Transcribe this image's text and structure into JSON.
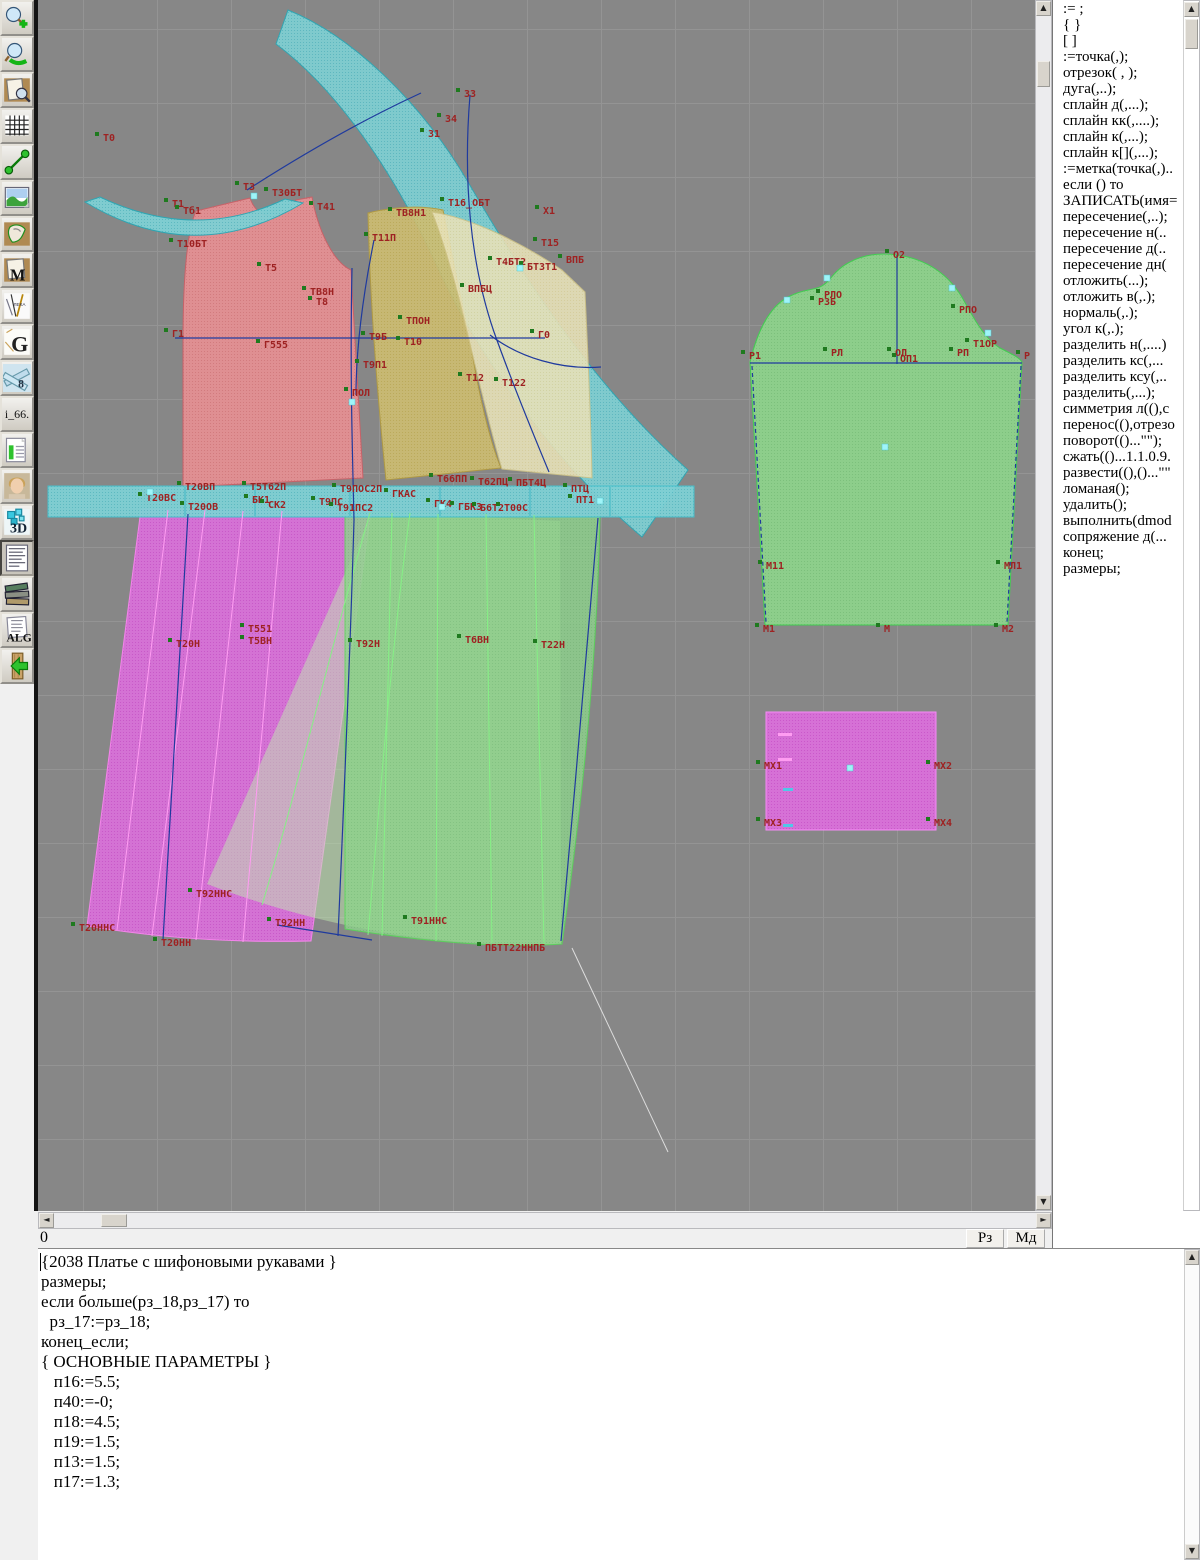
{
  "toolbar": {
    "buttons": [
      {
        "name": "zoom-in"
      },
      {
        "name": "zoom-out"
      },
      {
        "name": "print-preview"
      },
      {
        "name": "grid"
      },
      {
        "name": "measure"
      },
      {
        "name": "image-view"
      },
      {
        "name": "pattern-piece"
      },
      {
        "name": "pattern-m",
        "text": "M"
      },
      {
        "name": "drafting-tools"
      },
      {
        "name": "letter-g",
        "text": "G"
      },
      {
        "name": "rulers",
        "text": "8"
      },
      {
        "name": "i66",
        "text": "i_66."
      },
      {
        "name": "chart-table"
      },
      {
        "name": "portrait"
      },
      {
        "name": "view-3d",
        "text": "3D"
      },
      {
        "name": "text-document"
      },
      {
        "name": "books"
      },
      {
        "name": "alg",
        "text": "ALG"
      },
      {
        "name": "exit"
      }
    ]
  },
  "command_panel": {
    "items": [
      ":= ;",
      "{  }",
      "[  ]",
      ":=точка(,);",
      "отрезок( , );",
      "дуга(,..);",
      "сплайн  д(,...);",
      "сплайн  кк(,....);",
      "сплайн  к(,...);",
      "сплайн  к[](,...);",
      ":=метка(точка(,)..",
      "если () то",
      "ЗАПИСАТЬ(имя=",
      "пересечение(,..);",
      "пересечение  н(..",
      "пересечение  д(..",
      "пересечение  дн(",
      "отложить(...);",
      "отложить  в(,.);",
      "нормаль(,.);",
      "угол  к(,.);",
      "разделить  н(,....)",
      "разделить  кс(,...",
      "разделить  ксу(,..",
      "разделить(,...);",
      "симметрия  л((),с",
      "перенос((),отрезо",
      "поворот(()...\"\");",
      "сжать(()...1.1.0.9.",
      "развести((),()...\"\"",
      "ломаная();",
      "удалить();",
      "выполнить(dmod",
      "сопряжение  д(...",
      "конец;",
      "размеры;"
    ]
  },
  "status": {
    "coords": "0",
    "rz": "Рз",
    "md": "Мд"
  },
  "editor": {
    "lines": [
      "{2038 Платье с шифоновыми рукавами }",
      "",
      "размеры;",
      "",
      "если больше(рз_18,рз_17) то",
      "  рз_17:=рз_18;",
      "конец_если;",
      "",
      "{ ОСНОВНЫЕ ПАРАМЕТРЫ }",
      "   п16:=5.5;",
      "   п40:=-0;",
      "   п18:=4.5;",
      "   п19:=1.5;",
      "   п13:=1.5;",
      "   п17:=1.3;"
    ]
  },
  "canvas": {
    "colors": {
      "background": "#878787",
      "grid": "#949494",
      "cyan": "#7fd0d4",
      "red": "#e79093",
      "yellow": "#cdbd72",
      "pale_yellow": "#e7e1b8",
      "green": "#8ed48c",
      "magenta": "#dd70dd",
      "label": "#9e2222",
      "navy": "#1f3a9e"
    },
    "point_labels": [
      [
        "Т0",
        103,
        141
      ],
      [
        "Т3",
        243,
        190
      ],
      [
        "Т30БТ",
        272,
        196
      ],
      [
        "Т41",
        317,
        210
      ],
      [
        "Т1",
        172,
        207
      ],
      [
        "Тб1",
        183,
        214
      ],
      [
        "Т10БТ",
        177,
        247
      ],
      [
        "Т5",
        265,
        271
      ],
      [
        "Т11П",
        372,
        241
      ],
      [
        "33",
        464,
        97
      ],
      [
        "34",
        445,
        122
      ],
      [
        "31",
        428,
        137
      ],
      [
        "Х1",
        543,
        214
      ],
      [
        "Т15",
        541,
        246
      ],
      [
        "Т16_ОБТ",
        448,
        206
      ],
      [
        "ТВ8Н1",
        396,
        216
      ],
      [
        "ВПБ",
        566,
        263
      ],
      [
        "ВПБЦ",
        468,
        292
      ],
      [
        "Т4БТ2",
        496,
        265
      ],
      [
        "БТ3Т1",
        527,
        270
      ],
      [
        "ТПОН",
        406,
        324
      ],
      [
        "Т9Б",
        369,
        340
      ],
      [
        "Т10",
        404,
        345
      ],
      [
        "Г1",
        172,
        337
      ],
      [
        "Г555",
        264,
        348
      ],
      [
        "Г0",
        538,
        338
      ],
      [
        "Т9П1",
        363,
        368
      ],
      [
        "Т12",
        466,
        381
      ],
      [
        "Т122",
        502,
        386
      ],
      [
        "ПОЛ",
        352,
        396
      ],
      [
        "ТВ8Н",
        310,
        295
      ],
      [
        "Т8",
        316,
        305
      ],
      [
        "Т20ВП",
        185,
        490
      ],
      [
        "Т5Т62П",
        250,
        490
      ],
      [
        "Т9ПОС2П",
        340,
        492
      ],
      [
        "Т66ПП",
        437,
        482
      ],
      [
        "Т62ПЦ",
        478,
        485
      ],
      [
        "ПБТ4Ц",
        516,
        486
      ],
      [
        "ПТЦ",
        571,
        492
      ],
      [
        "ПТ1",
        576,
        503
      ],
      [
        "Т20ВС",
        146,
        501
      ],
      [
        "Т20ОВ",
        188,
        510
      ],
      [
        "БК1",
        252,
        503
      ],
      [
        "СК2",
        268,
        508
      ],
      [
        "Т9ПС",
        319,
        505
      ],
      [
        "Т91ПС2",
        337,
        511
      ],
      [
        "ГКАС",
        392,
        497
      ],
      [
        "ГК4",
        434,
        507
      ],
      [
        "ГБК3",
        458,
        510
      ],
      [
        "Б6Т2",
        480,
        511
      ],
      [
        "Т00С",
        504,
        511
      ],
      [
        "Т20Н",
        176,
        647
      ],
      [
        "Т551",
        248,
        632
      ],
      [
        "Т5ВН",
        248,
        644
      ],
      [
        "Т92Н",
        356,
        647
      ],
      [
        "Т6ВН",
        465,
        643
      ],
      [
        "Т22Н",
        541,
        648
      ],
      [
        "Т92ННС",
        196,
        897
      ],
      [
        "Т20ННС",
        79,
        931
      ],
      [
        "Т20НН",
        161,
        946
      ],
      [
        "Т92НН",
        275,
        926
      ],
      [
        "Т91ННС",
        411,
        924
      ],
      [
        "ПБТТ22ННПБ",
        485,
        951
      ],
      [
        "О2",
        893,
        258
      ],
      [
        "РЛО",
        824,
        298
      ],
      [
        "РЗБ",
        818,
        305
      ],
      [
        "РПО",
        959,
        313
      ],
      [
        "Т1ОР",
        973,
        347
      ],
      [
        "РЛ",
        831,
        356
      ],
      [
        "ОЛ",
        895,
        356
      ],
      [
        "ОП1",
        900,
        362
      ],
      [
        "РП",
        957,
        356
      ],
      [
        "Р1",
        749,
        359
      ],
      [
        "Р",
        1024,
        359
      ],
      [
        "М11",
        766,
        569
      ],
      [
        "МЛ1",
        1004,
        569
      ],
      [
        "М1",
        763,
        632
      ],
      [
        "М",
        884,
        632
      ],
      [
        "М2",
        1002,
        632
      ],
      [
        "МХ1",
        764,
        769
      ],
      [
        "МХ2",
        934,
        769
      ],
      [
        "МХ3",
        764,
        826
      ],
      [
        "МХ4",
        934,
        826
      ]
    ],
    "handles": [
      [
        150,
        492
      ],
      [
        885,
        447
      ],
      [
        850,
        768
      ],
      [
        352,
        402
      ],
      [
        520,
        268
      ],
      [
        254,
        196
      ],
      [
        442,
        507
      ],
      [
        600,
        501
      ],
      [
        787,
        300
      ],
      [
        827,
        278
      ],
      [
        952,
        288
      ],
      [
        988,
        333
      ]
    ]
  }
}
